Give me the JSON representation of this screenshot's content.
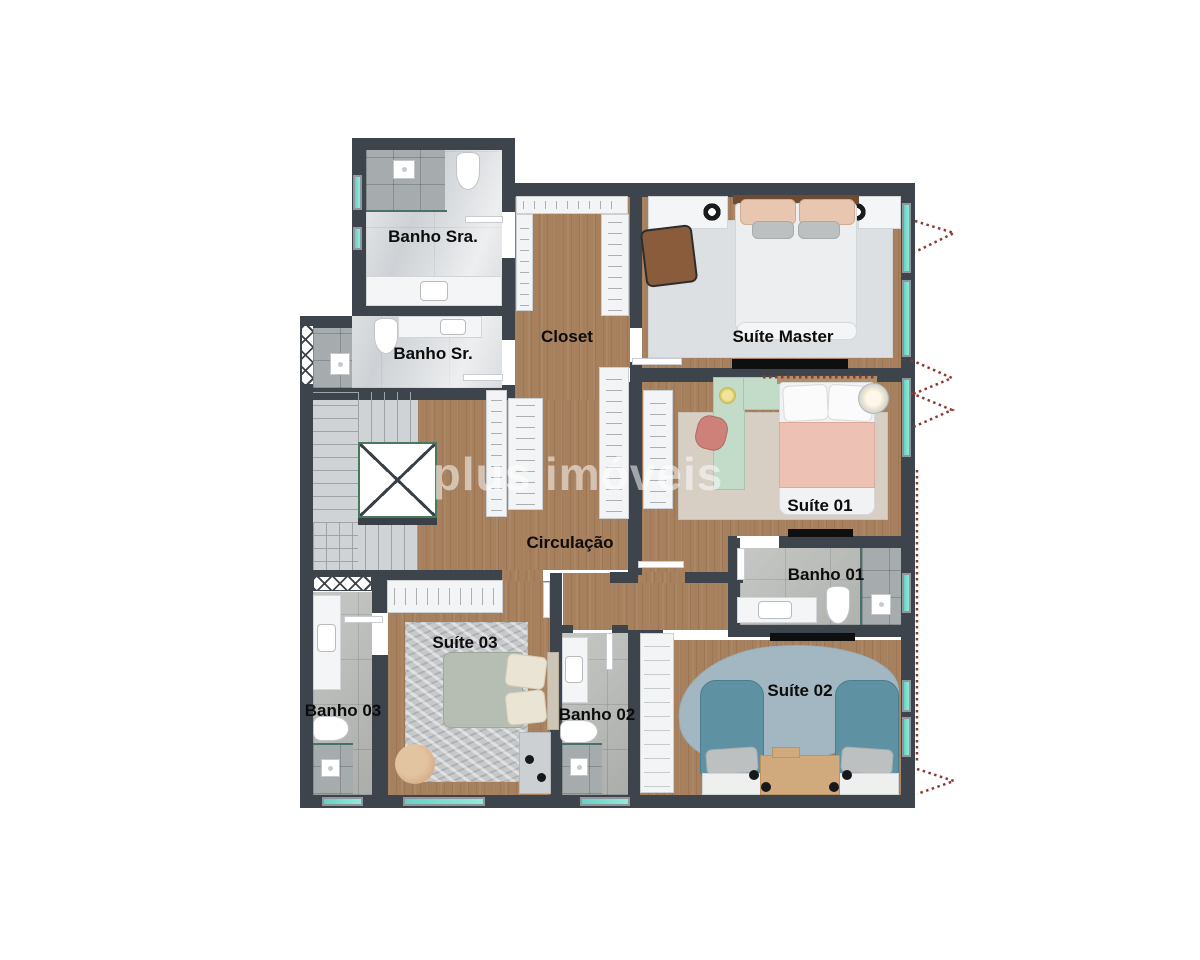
{
  "title": "Apartment floor plan - upper suites level",
  "watermark": {
    "text": "plus imóveis"
  },
  "rooms": {
    "banho_sra": {
      "label": "Banho Sra."
    },
    "banho_sr": {
      "label": "Banho Sr."
    },
    "closet": {
      "label": "Closet"
    },
    "suite_master": {
      "label": "Suíte Master"
    },
    "suite_01": {
      "label": "Suíte 01"
    },
    "banho_01": {
      "label": "Banho 01"
    },
    "circulacao": {
      "label": "Circulação"
    },
    "suite_03": {
      "label": "Suíte 03"
    },
    "banho_03": {
      "label": "Banho 03"
    },
    "banho_02": {
      "label": "Banho 02"
    },
    "suite_02": {
      "label": "Suíte 02"
    }
  },
  "palette": {
    "wall": "#3e444b",
    "wood_floor": "#a7805d",
    "marble_floor": "#dadde0",
    "gray_tile": "#b5b8b4",
    "window_glass": "#7adfd2",
    "view_arrow_red": "#8a3a31",
    "void_border_green": "#49795d",
    "bed_master": "#eceef0",
    "bed_suite01_pink": "#edc2b5",
    "bed_suite02_teal": "#5e92a3",
    "bed_suite03_sage": "#b6bdb3"
  }
}
